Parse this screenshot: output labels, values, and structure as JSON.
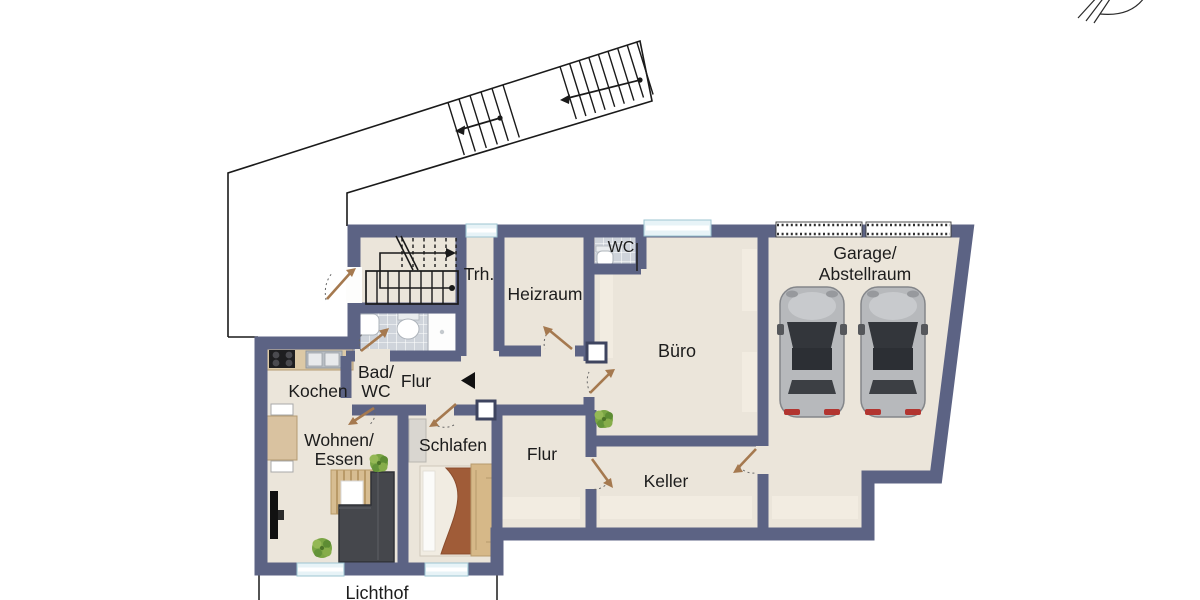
{
  "plan": {
    "labels": {
      "trh": "Trh.",
      "heizraum": "Heizraum",
      "wc_top": "WC",
      "buero": "Büro",
      "garage_line1": "Garage/",
      "garage_line2": "Abstellraum",
      "kochen": "Kochen",
      "bad_line1": "Bad/",
      "bad_line2": "WC",
      "flur_upper": "Flur",
      "wohnen_line1": "Wohnen/",
      "wohnen_line2": "Essen",
      "schlafen": "Schlafen",
      "flur_lower": "Flur",
      "keller": "Keller",
      "lichthof": "Lichthof"
    },
    "colors": {
      "wall": "#5c6384",
      "floor": "#ebe5da",
      "tile_room": "#cfd4db",
      "window": "#e7f3f7",
      "door_swing": "#a5794f",
      "sofa": "#45474c",
      "wood": "#d9c2a0",
      "car_body": "#b7b9bc",
      "blanket": "#a05c38",
      "plant": "#7aa544"
    },
    "features": {
      "cars_in_garage": 2,
      "plants": 3,
      "exterior_stair_flights": 2,
      "interior_staircase_room": "Trh.",
      "light_well": "Lichthof"
    }
  }
}
